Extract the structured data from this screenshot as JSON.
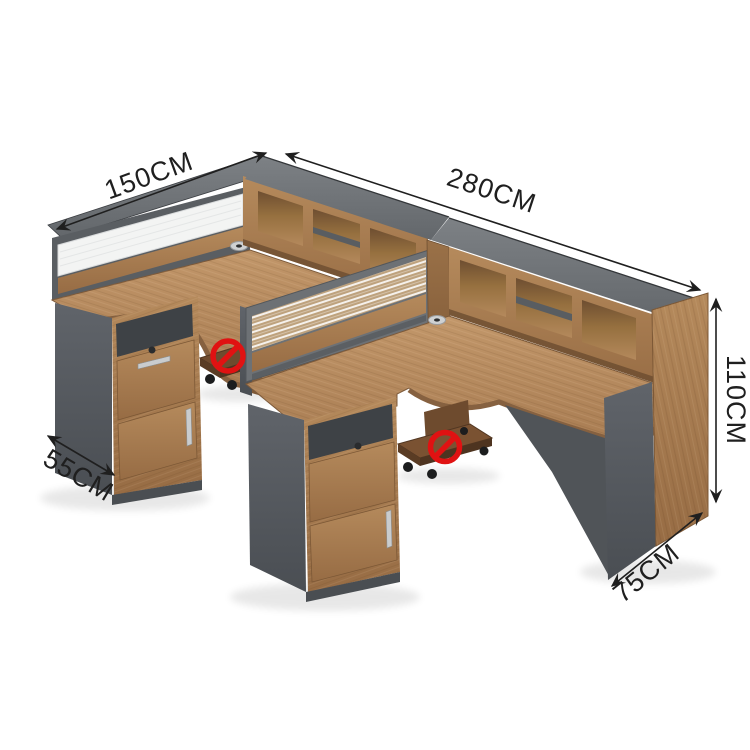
{
  "image_type": "product-dimension-diagram",
  "product": "Two-person L-shaped office workstation with hutch, screens, pedestals and CPU carts",
  "dimensions": {
    "left_width": {
      "label": "150CM"
    },
    "total_width": {
      "label": "280CM"
    },
    "height": {
      "label": "110CM"
    },
    "left_depth": {
      "label": "55CM"
    },
    "right_depth": {
      "label": "75CM"
    }
  },
  "icons": [
    {
      "name": "no-wheels-icon",
      "glyph": "circle-slash",
      "color": "#e01212",
      "count": 2
    }
  ],
  "colors": {
    "background": "#ffffff",
    "wood": "#b1875e",
    "wood_dark": "#8a6340",
    "wood_face": "#a87c52",
    "panel_gray": "#5a5e62",
    "panel_gray_light": "#73777b",
    "glass": "#f3f4f3",
    "shelf_gray": "#595d61",
    "dimension_line": "#1f1f1f",
    "prohibition_red": "#e01212"
  }
}
